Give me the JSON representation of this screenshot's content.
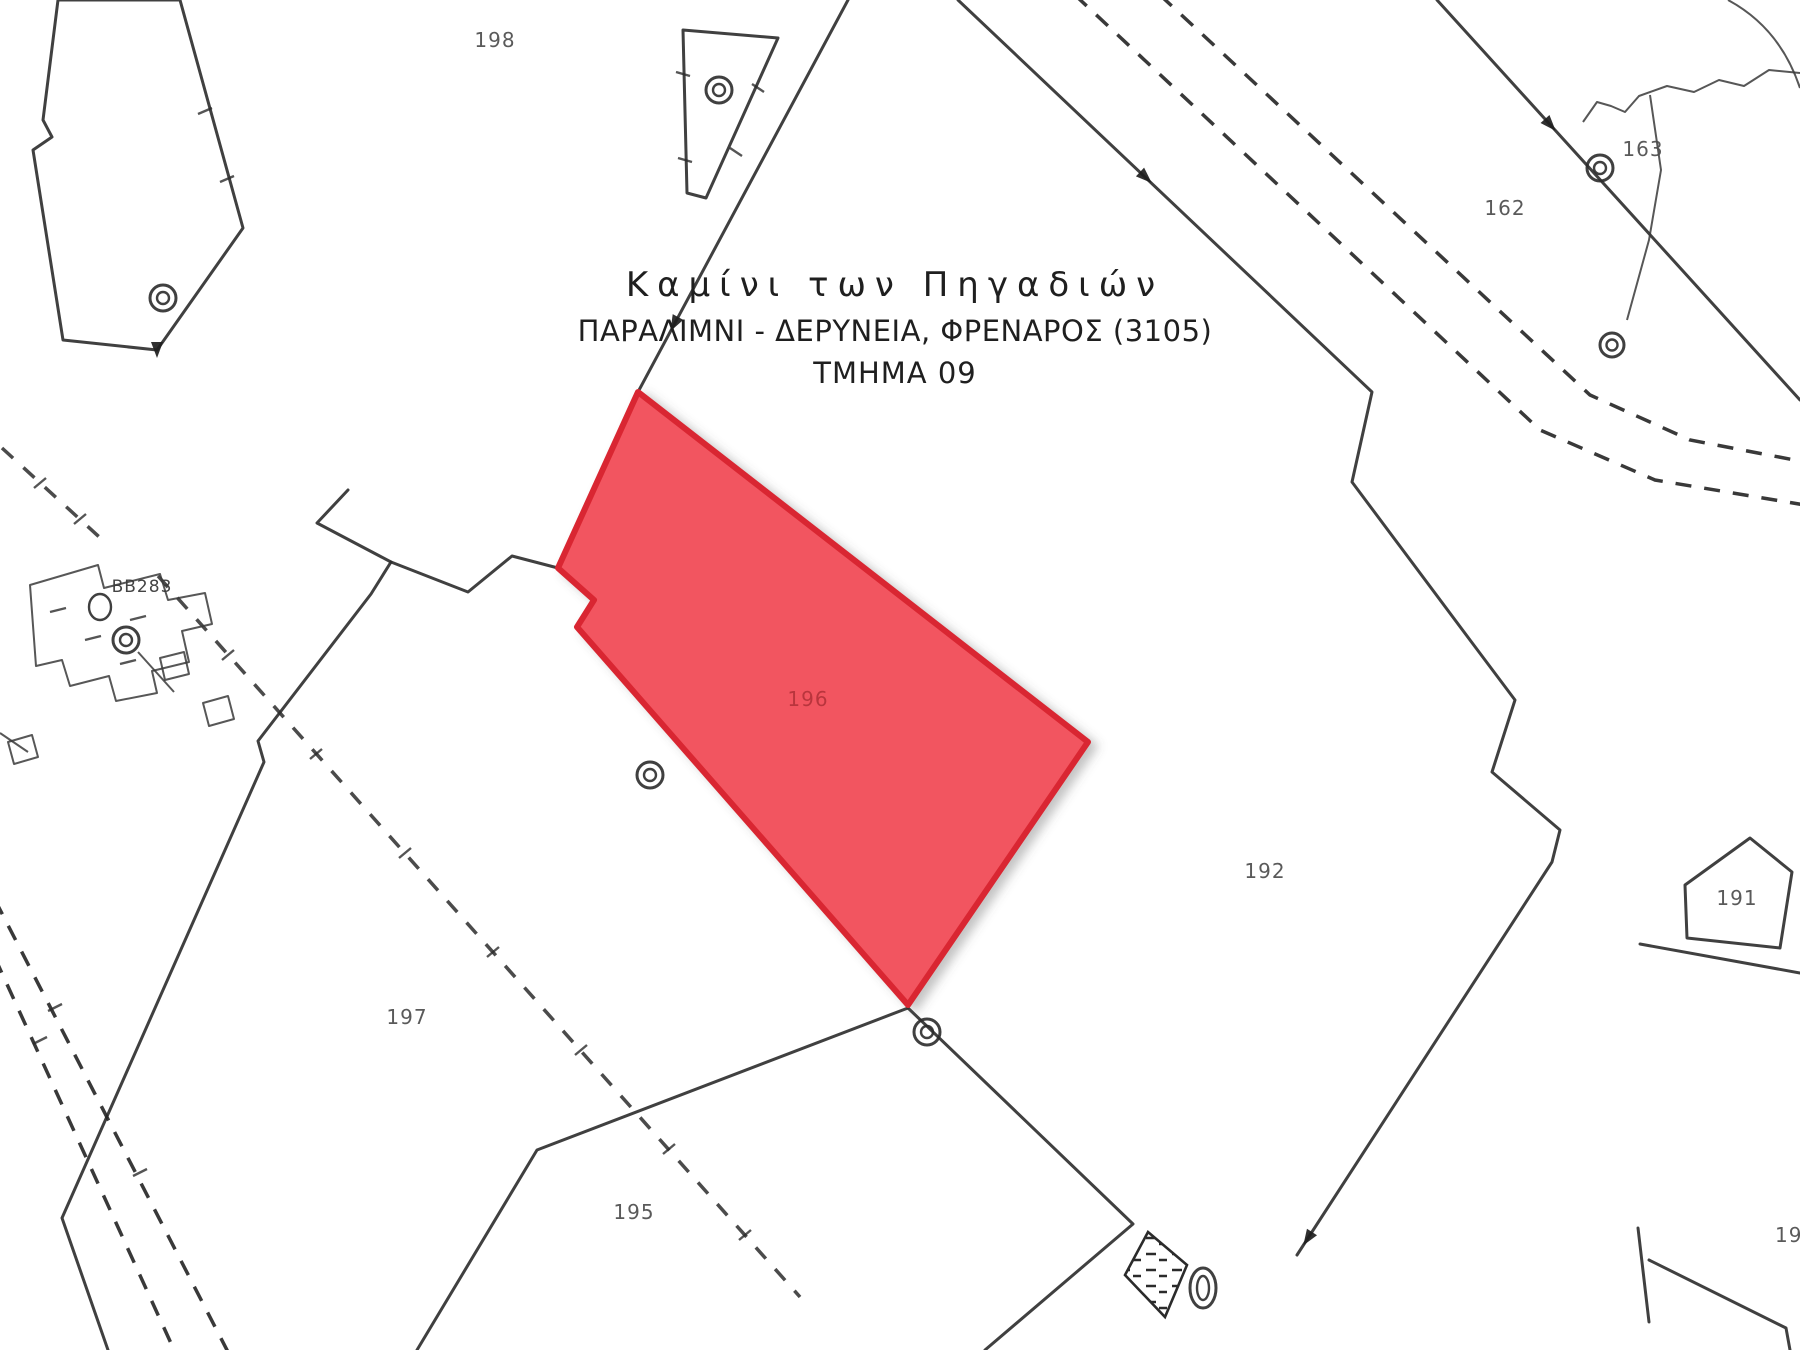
{
  "page": {
    "background": "#ffffff"
  },
  "title_block": {
    "locality": "Καμίνι των Πηγαδιών",
    "plan": "ΠΑΡΑΛΙΜΝΙ - ΔΕΡΥΝΕΙΑ, ΦΡΕΝΑΡΟΣ (3105)",
    "sheet": "ΤΜΗΜΑ 09"
  },
  "highlighted_parcel": {
    "number": "196",
    "fill": "#f25560",
    "border": "#d92730"
  },
  "parcel_numbers": {
    "p198": "198",
    "p163": "163",
    "p162": "162",
    "p192": "192",
    "p191": "191",
    "p197": "197",
    "p195": "195",
    "p190": "190"
  },
  "survey": {
    "ref": "BB283"
  },
  "colors": {
    "boundary": "#2b2b2b",
    "label": "#4d4d4d",
    "red_label": "#b03038"
  }
}
